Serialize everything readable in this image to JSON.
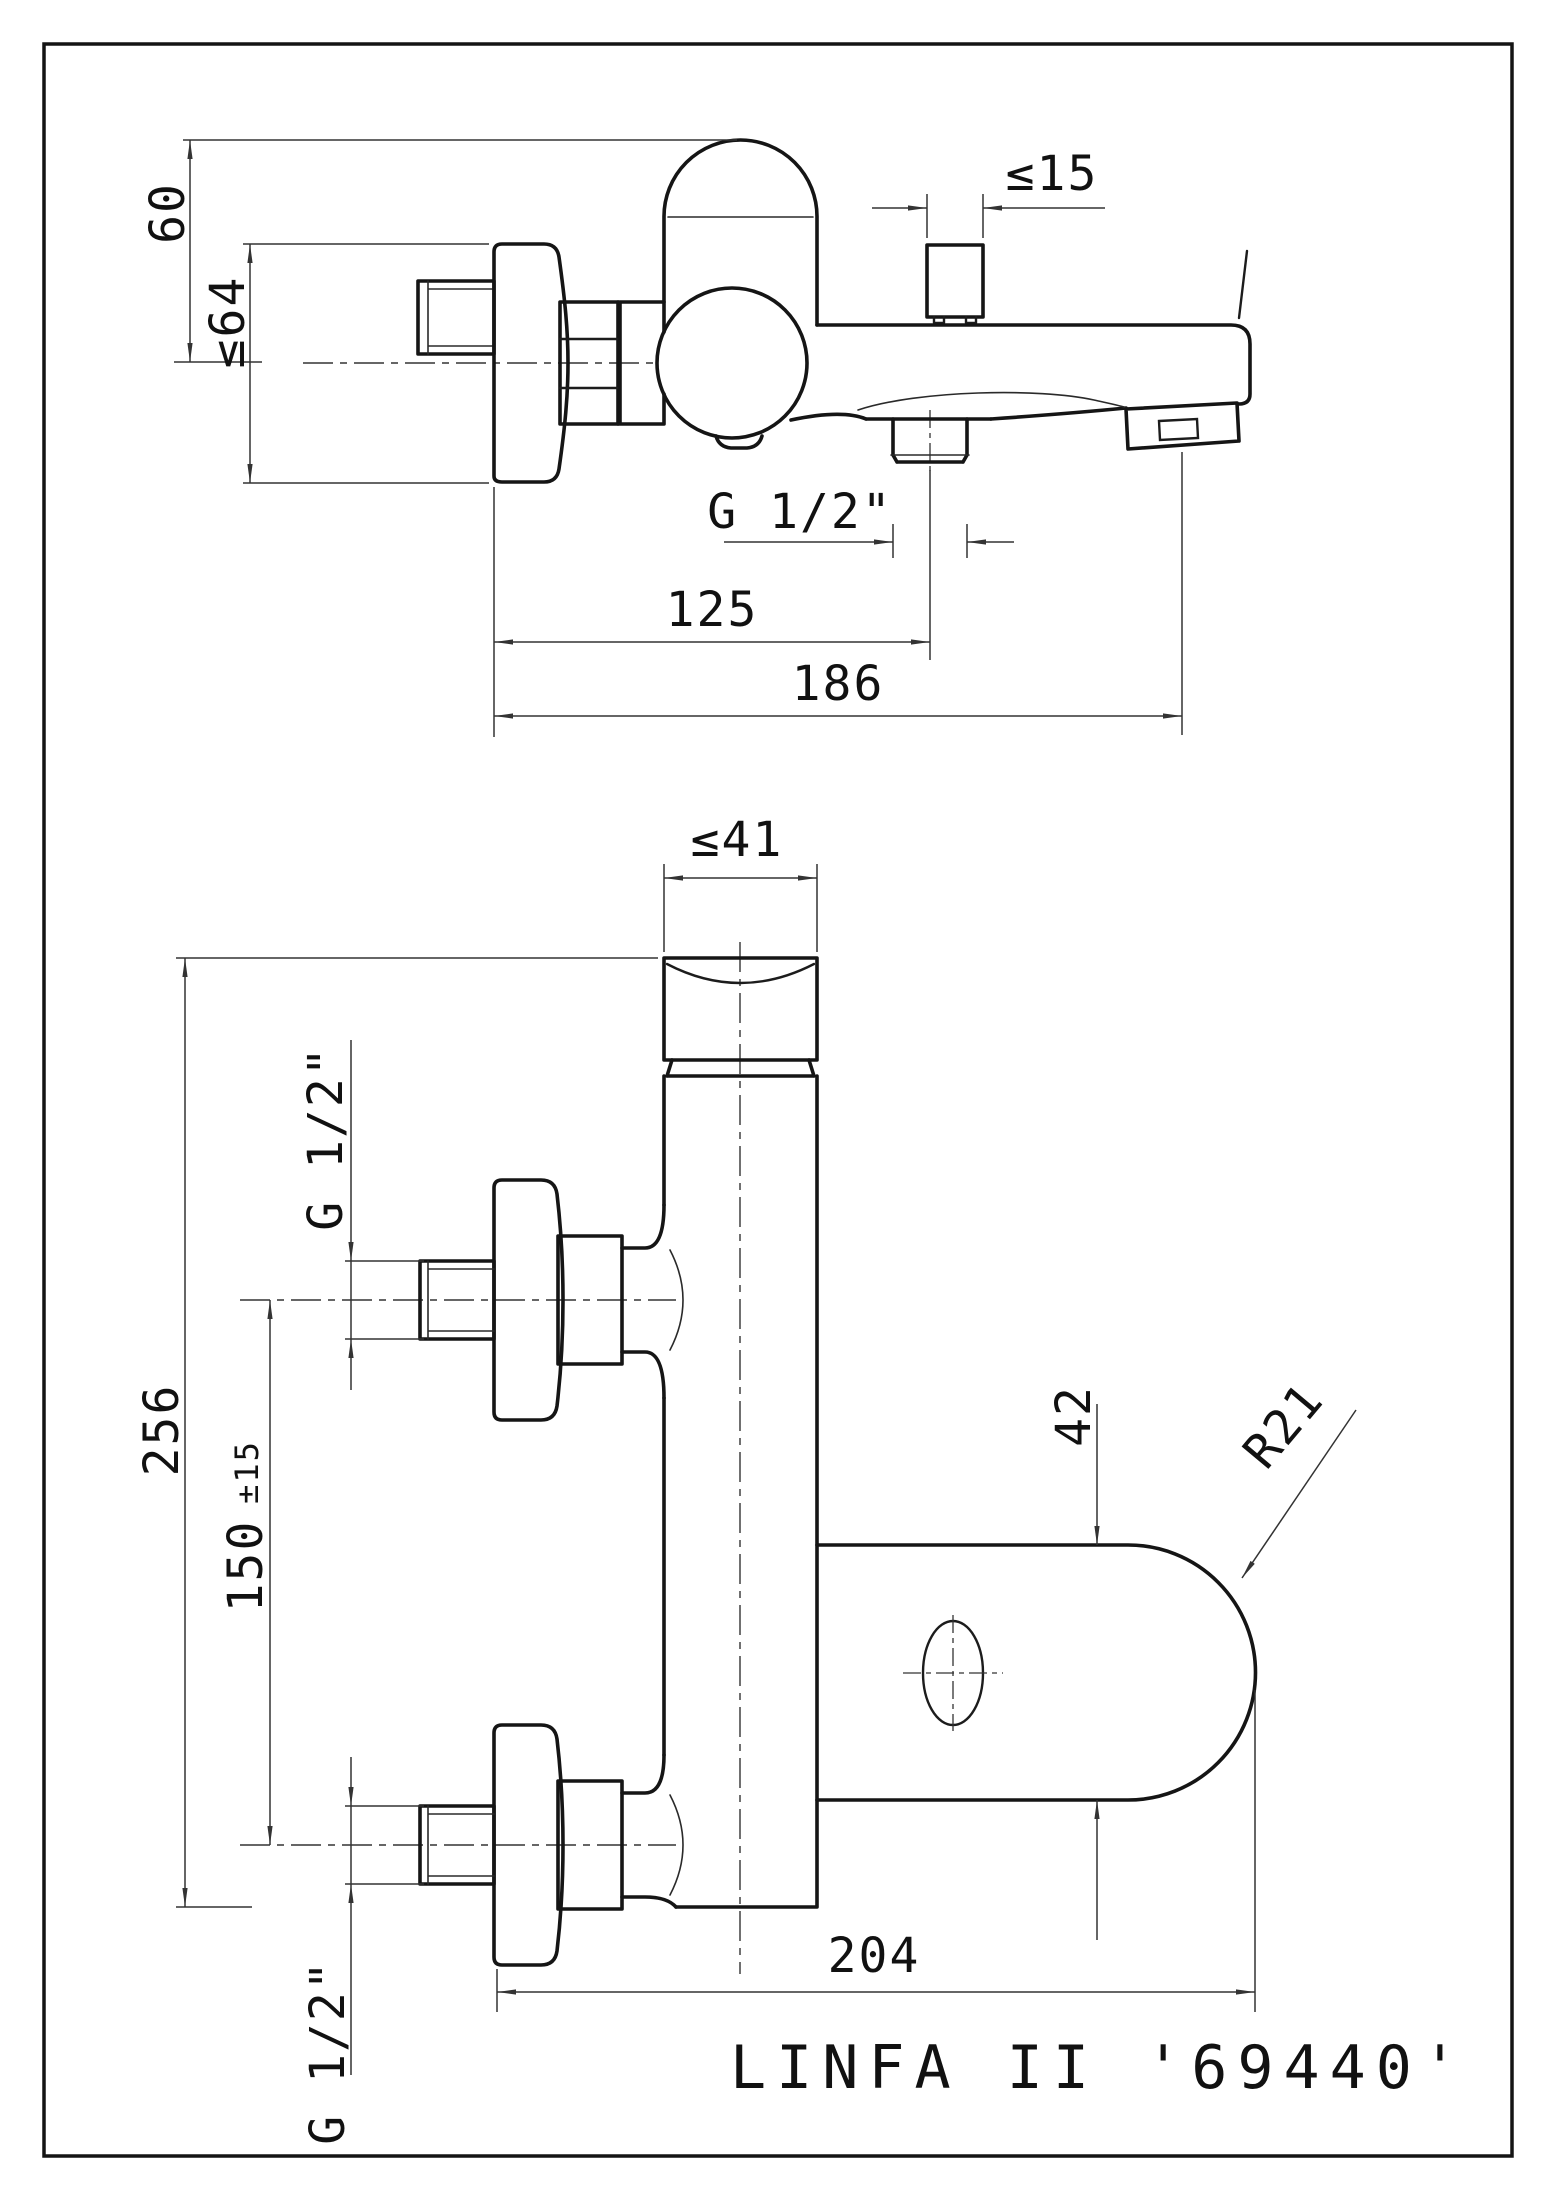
{
  "title_block": {
    "model": "LINFA II '69440'"
  },
  "top_view": {
    "dims": {
      "handle_height": "60",
      "escutcheon_dia": "≤64",
      "diverter_dia": "≤15",
      "outlet_thread": "G 1/2\"",
      "outlet_offset": "125",
      "spout_reach": "186"
    }
  },
  "front_view": {
    "dims": {
      "body_dia": "≤41",
      "inlet_thread_upper": "G 1/2\"",
      "overall_height": "256",
      "inlet_spacing": "150",
      "inlet_spacing_tol": "±15",
      "bracket_height": "42",
      "bracket_radius": "R21",
      "inlet_thread_lower": "G 1/2\"",
      "wall_to_bracket": "204"
    }
  }
}
